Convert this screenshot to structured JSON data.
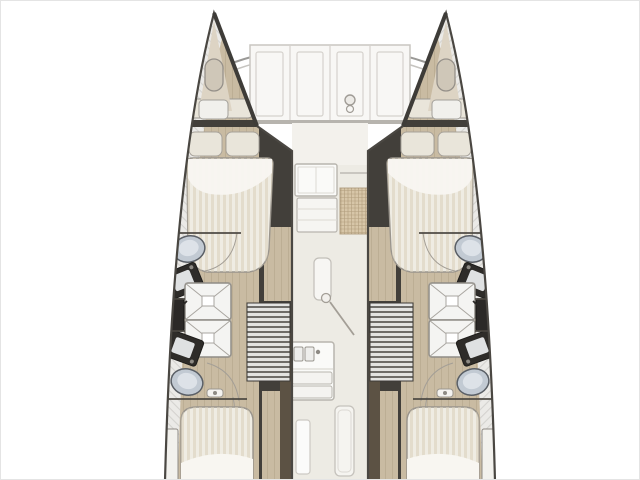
{
  "title": "Catamaran interior layout deck plan",
  "colors": {
    "hull_outline": "#4a4742",
    "shell": "#ebeae7",
    "shell_hatch": "#b7b5b1",
    "wood": "#c9bba2",
    "plank": "#ac9e83",
    "dark_wall": "#423f3a",
    "brown_wall": "#5c5244",
    "saloon_floor": "#edebe4",
    "saloon_front": "#f3f1ec",
    "foredeck_panel": "#f8f7f5",
    "panel_line": "#d5d2cd",
    "bed_base": "#efece3",
    "bed_stripe": "#d9cfba",
    "sheet": "#f8f6f1",
    "pillow": "#e9e5da",
    "toilet": "#c2cad3",
    "toilet_edge": "#5a5f66",
    "fixture_dark": "#2e2c29",
    "basin_light": "#dfe1e2",
    "shower": "#f4f4f2",
    "shower_line": "#a9a6a0",
    "mat": "#d7c6a8",
    "mat_line": "#8a7450",
    "white_unit": "#fafaf8",
    "unit_outline": "#b8b5ae",
    "steps_light": "#e3e3e1",
    "steps_dark": "#6e6c68",
    "beam_line": "#9a9996",
    "swing_line": "#a39e96",
    "metal": "#8d8a84"
  },
  "plan": {
    "vessel_type": "catamaran",
    "view": "top-down interior deck plan",
    "foredeck": {
      "panel_count": 4,
      "features": [
        "bow-crossbeam",
        "anchor-windlass",
        "port-bow-hatch",
        "starboard-bow-hatch",
        "bow-lockers"
      ]
    },
    "saloon": {
      "features": [
        "forward-galley-counter",
        "galley-drawers",
        "floor-mat",
        "side-counter",
        "door-swing",
        "aft-galley-sink",
        "aft-locker-panel",
        "aft-door"
      ]
    },
    "port_hull": {
      "rooms": [
        "forward-double-cabin",
        "forward-head",
        "aft-head",
        "aft-double-cabin"
      ],
      "fixtures": [
        "double-berth-with-pillows",
        "toilet",
        "washbasin",
        "shower-stall",
        "shower-stall",
        "washbasin",
        "toilet",
        "vanity-cabinet",
        "companionway-stairs",
        "aft-berth",
        "side-locker"
      ]
    },
    "starboard_hull": {
      "rooms": [
        "forward-double-cabin",
        "forward-head",
        "aft-head",
        "aft-double-cabin"
      ],
      "fixtures": [
        "double-berth-with-pillows",
        "toilet",
        "washbasin",
        "shower-stall",
        "shower-stall",
        "washbasin",
        "toilet",
        "vanity-cabinet",
        "companionway-stairs",
        "aft-berth",
        "side-locker"
      ]
    }
  }
}
